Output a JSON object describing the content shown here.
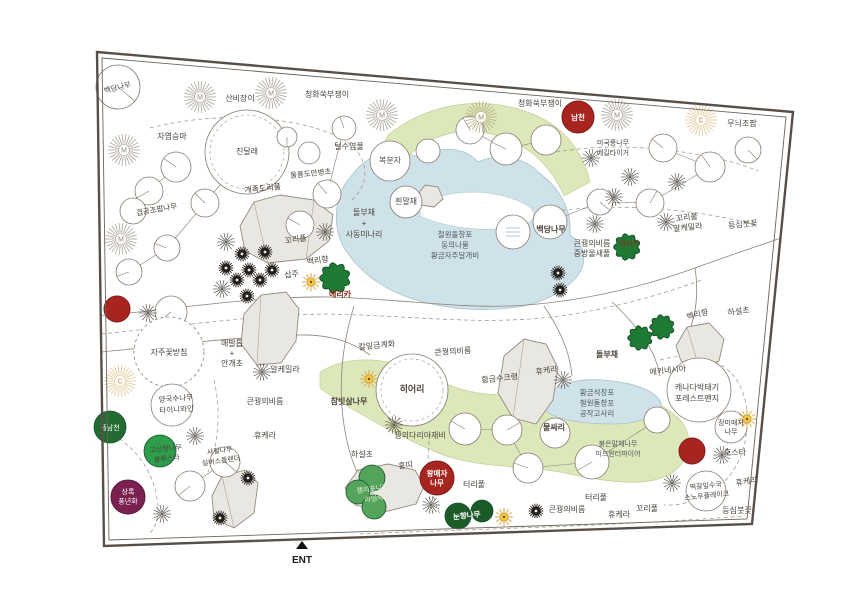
{
  "canvas": {
    "width": 850,
    "height": 600,
    "background": "#ffffff"
  },
  "palette": {
    "ink": "#4a443c",
    "pond_text": "#4e5a60",
    "accent_red_text": "#8b2b20",
    "white": "#ffffff",
    "line": "#8d8276",
    "dash": "#9b9186",
    "circle_edge": "#867b6e",
    "border": "#57504a",
    "border_inner": "#6d6459",
    "green_bed": "#dce7ba",
    "green_bed_edge": "#c3cf97",
    "pond": "#cfe2e9",
    "pond_edge": "#a9c2cb",
    "rock_fill": "#e9e7e2",
    "rock_edge": "#938b80",
    "rock_chord": "#aaa299",
    "red": "#a8241f",
    "red_edge": "#7e1b18",
    "maroon": "#7a2150",
    "maroon_edge": "#5c163b",
    "sun": "#f5c844",
    "sun_edge": "#cd9334",
    "sun_ray": "#dfa63c",
    "conifer": "#1f7a33",
    "conifer_edge": "#14532d",
    "pom": "#231e19",
    "star": "#3e3933",
    "burst_grey": "#b3aea6",
    "burst_olive": "#bcb488",
    "burst_tan": "#e6cda2",
    "burst_letter_grey": "#8d867c",
    "burst_letter_olive": "#8f8a5f",
    "burst_letter_tan": "#d08a33"
  },
  "border": {
    "outer": "97,52 793,112 752,524 104,546",
    "inner": "102,58 786,117 747,519 109,540"
  },
  "entrance": {
    "label": "ENT",
    "x": 302,
    "y": 563,
    "arrow": "296,549 308,549 302,541"
  },
  "beds": {
    "green": [
      "M388,135 C430,102 485,94 535,115 C565,128 583,152 590,182 L564,196 C552,168 532,148 504,138 C466,124 430,133 404,160 C398,167 394,176 392,186 L380,170 C380,156 383,145 388,135 Z",
      "M320,372 C352,352 395,358 438,380 C478,400 515,396 555,390 C600,383 648,392 676,416 C692,430 694,452 678,468 C658,488 616,484 570,474 C525,464 478,470 436,452 C396,435 344,406 320,388 Z"
    ],
    "ponds": [
      "M358,168 C375,150 400,148 420,158 C440,145 465,147 478,162 C500,152 525,158 538,172 C560,188 572,210 570,235 C585,245 588,262 578,275 C565,292 540,305 510,308 C475,312 440,308 410,298 C380,288 355,268 342,244 C332,222 336,195 348,180 Z",
      "M545,401 C550,386 575,378 602,380 C632,382 656,390 661,403 C663,415 640,424 612,424 C585,424 556,420 546,411 Z"
    ],
    "pond_islands": [
      "M420,206 C450,186 500,189 528,206 C538,213 536,222 518,226 C480,234 442,226 420,216 Z"
    ]
  },
  "rocks": [
    {
      "pts": "240,226 254,202 280,195 314,200 333,215 329,241 306,259 268,263 245,251",
      "chords": [
        "M254,202 L268,263",
        "M314,200 L306,259"
      ]
    },
    {
      "pts": "244,314 261,295 286,292 299,309 296,341 281,363 257,365 241,344",
      "chords": [
        "M261,295 L257,365"
      ]
    },
    {
      "pts": "504,356 524,339 546,344 558,368 553,400 536,424 513,418 498,393",
      "chords": [
        "M524,339 L513,418"
      ]
    },
    {
      "pts": "345,488 358,470 388,464 415,470 424,486 416,504 384,512 355,505",
      "chords": [
        "M358,470 L384,512"
      ]
    },
    {
      "pts": "212,496 222,476 246,470 258,483 254,513 234,528 214,519",
      "chords": [
        "M222,476 L234,528"
      ]
    },
    {
      "pts": "676,346 687,327 709,323 724,339 719,361 699,368 681,361",
      "chords": [
        "M687,327 L699,368"
      ]
    },
    {
      "pts": "416,197 425,185 438,187 443,199 434,207 420,205",
      "chords": []
    }
  ],
  "paths": {
    "solid": [
      "M101,316 C180,308 260,296 330,297 C400,299 455,308 510,306 C575,303 640,288 695,268 C725,257 755,247 781,238",
      "M102,352 C170,345 235,337 298,335 C330,334 352,342 370,355",
      "M354,306 C342,345 338,385 344,425 C348,455 360,485 378,508",
      "M612,302 C640,328 656,352 660,376",
      "M695,268 C700,300 694,330 678,352",
      "M544,306 C560,330 570,352 572,376"
    ],
    "dashed": [
      "M150,128 C220,110 300,116 345,140 C368,155 372,182 352,200",
      "M556,152 C610,143 665,147 715,158 C735,162 748,167 758,171",
      "M548,212 C605,204 660,207 710,215 C732,219 748,222 757,225",
      "M660,360 C695,350 725,360 738,382 C753,408 749,447 733,471 C716,496 688,506 664,505",
      "M360,534 C470,529 600,527 745,516",
      "M101,428 C133,443 152,468 157,498 C160,516 156,528 148,535",
      "M101,334 C180,326 255,315 325,314 C395,315 450,322 510,320 C580,318 645,300 702,280",
      "M214,380 C221,410 219,442 208,472",
      "M430,434 C426,460 428,488 440,514"
    ],
    "segments": [
      [
        176,
        167,
        149,
        191
      ],
      [
        149,
        191,
        133,
        211
      ],
      [
        205,
        203,
        167,
        248
      ],
      [
        167,
        248,
        129,
        272
      ],
      [
        247,
        152,
        205,
        203
      ],
      [
        344,
        128,
        327,
        194
      ],
      [
        327,
        194,
        300,
        225
      ],
      [
        663,
        148,
        710,
        167
      ],
      [
        710,
        167,
        650,
        203
      ],
      [
        650,
        203,
        600,
        202
      ],
      [
        600,
        202,
        550,
        222
      ],
      [
        546,
        140,
        506,
        149
      ],
      [
        506,
        149,
        470,
        130
      ],
      [
        465,
        429,
        507,
        430
      ],
      [
        507,
        430,
        528,
        468
      ],
      [
        528,
        468,
        592,
        462
      ],
      [
        592,
        462,
        657,
        420
      ],
      [
        190,
        486,
        225,
        462
      ]
    ]
  },
  "trees": [
    {
      "x": 118,
      "y": 87,
      "r": 22,
      "a": 40
    },
    {
      "x": 247,
      "y": 152,
      "r": 42,
      "inner": true
    },
    {
      "x": 176,
      "y": 167,
      "r": 15,
      "a": 215
    },
    {
      "x": 149,
      "y": 191,
      "r": 14,
      "a": 150
    },
    {
      "x": 133,
      "y": 211,
      "r": 13
    },
    {
      "x": 205,
      "y": 203,
      "r": 14,
      "a": 225
    },
    {
      "x": 167,
      "y": 248,
      "r": 13,
      "a": 200
    },
    {
      "x": 129,
      "y": 272,
      "r": 13,
      "a": 160
    },
    {
      "x": 287,
      "y": 137,
      "r": 10,
      "a": 90
    },
    {
      "x": 344,
      "y": 128,
      "r": 12,
      "a": 250
    },
    {
      "x": 309,
      "y": 153,
      "r": 11
    },
    {
      "x": 327,
      "y": 194,
      "r": 14,
      "a": 230
    },
    {
      "x": 390,
      "y": 161,
      "r": 20
    },
    {
      "x": 406,
      "y": 202,
      "r": 16
    },
    {
      "x": 470,
      "y": 130,
      "r": 14,
      "a": 240
    },
    {
      "x": 506,
      "y": 149,
      "r": 16,
      "a": 205
    },
    {
      "x": 546,
      "y": 140,
      "r": 15
    },
    {
      "x": 428,
      "y": 151,
      "r": 12
    },
    {
      "x": 663,
      "y": 148,
      "r": 14,
      "a": 220
    },
    {
      "x": 710,
      "y": 167,
      "r": 15,
      "a": 235
    },
    {
      "x": 600,
      "y": 202,
      "r": 13,
      "a": 40
    },
    {
      "x": 650,
      "y": 203,
      "r": 14,
      "a": 300
    },
    {
      "x": 748,
      "y": 150,
      "r": 13,
      "a": 45
    },
    {
      "x": 550,
      "y": 222,
      "r": 17
    },
    {
      "x": 513,
      "y": 232,
      "r": 17,
      "waves": true
    },
    {
      "x": 300,
      "y": 225,
      "r": 14,
      "a": 210
    },
    {
      "x": 171,
      "y": 312,
      "r": 16,
      "a": 140
    },
    {
      "x": 169,
      "y": 352,
      "r": 35,
      "dash": true
    },
    {
      "x": 172,
      "y": 405,
      "r": 21
    },
    {
      "x": 225,
      "y": 462,
      "r": 15,
      "a": 40
    },
    {
      "x": 190,
      "y": 486,
      "r": 15,
      "a": 140
    },
    {
      "x": 412,
      "y": 390,
      "r": 36,
      "inner": true
    },
    {
      "x": 465,
      "y": 429,
      "r": 16,
      "a": 210
    },
    {
      "x": 507,
      "y": 430,
      "r": 15,
      "a": 330
    },
    {
      "x": 528,
      "y": 468,
      "r": 15,
      "a": 200
    },
    {
      "x": 592,
      "y": 462,
      "r": 17,
      "a": 150
    },
    {
      "x": 657,
      "y": 420,
      "r": 13
    },
    {
      "x": 555,
      "y": 433,
      "r": 15
    },
    {
      "x": 699,
      "y": 390,
      "r": 32
    },
    {
      "x": 731,
      "y": 427,
      "r": 16
    },
    {
      "x": 706,
      "y": 491,
      "r": 20
    }
  ],
  "icons": {
    "sunbursts": [
      {
        "x": 124,
        "y": 150,
        "letter": "M",
        "variant": "grey"
      },
      {
        "x": 200,
        "y": 97,
        "letter": "M",
        "variant": "grey"
      },
      {
        "x": 271,
        "y": 93,
        "letter": "M",
        "variant": "grey"
      },
      {
        "x": 382,
        "y": 115,
        "letter": "M",
        "variant": "grey"
      },
      {
        "x": 617,
        "y": 115,
        "letter": "M",
        "variant": "grey"
      },
      {
        "x": 121,
        "y": 239,
        "letter": "M",
        "variant": "grey"
      },
      {
        "x": 481,
        "y": 117,
        "letter": "M",
        "variant": "olive"
      },
      {
        "x": 701,
        "y": 120,
        "letter": "C",
        "variant": "tan"
      },
      {
        "x": 120,
        "y": 381,
        "letter": "C",
        "variant": "tan"
      }
    ],
    "stars": [
      [
        226,
        242
      ],
      [
        325,
        232
      ],
      [
        222,
        289
      ],
      [
        148,
        313
      ],
      [
        262,
        372
      ],
      [
        195,
        436
      ],
      [
        162,
        514
      ],
      [
        431,
        505
      ],
      [
        563,
        380
      ],
      [
        672,
        483
      ],
      [
        722,
        455
      ],
      [
        591,
        158
      ],
      [
        630,
        177
      ],
      [
        677,
        182
      ],
      [
        614,
        197
      ],
      [
        595,
        224
      ],
      [
        666,
        222
      ],
      [
        394,
        425
      ]
    ],
    "poms": [
      [
        242,
        254
      ],
      [
        265,
        252
      ],
      [
        226,
        268
      ],
      [
        249,
        270
      ],
      [
        272,
        270
      ],
      [
        237,
        280
      ],
      [
        260,
        280
      ],
      [
        247,
        296
      ],
      [
        558,
        273
      ],
      [
        560,
        290
      ],
      [
        248,
        478
      ],
      [
        220,
        518
      ],
      [
        536,
        511
      ]
    ],
    "suns": [
      [
        311,
        282
      ],
      [
        369,
        379
      ],
      [
        504,
        517
      ],
      [
        747,
        419
      ]
    ],
    "conifers": [
      [
        335,
        278,
        15
      ],
      [
        627,
        247,
        13
      ],
      [
        640,
        338,
        12
      ],
      [
        662,
        327,
        12
      ]
    ]
  },
  "shrubs": {
    "red": [
      {
        "x": 578,
        "y": 117,
        "r": 16
      },
      {
        "x": 117,
        "y": 309,
        "r": 13
      },
      {
        "x": 692,
        "y": 451,
        "r": 13
      },
      {
        "x": 437,
        "y": 478,
        "r": 17
      }
    ],
    "green": [
      {
        "x": 110,
        "y": 427,
        "r": 16,
        "fill": "#236b32"
      },
      {
        "x": 160,
        "y": 451,
        "r": 16,
        "fill": "#2e9e4b"
      },
      {
        "x": 372,
        "y": 478,
        "r": 13,
        "fill": "#55a45b"
      },
      {
        "x": 358,
        "y": 492,
        "r": 12,
        "fill": "#55a45b"
      },
      {
        "x": 374,
        "y": 507,
        "r": 12,
        "fill": "#55a45b"
      },
      {
        "x": 458,
        "y": 516,
        "r": 13,
        "fill": "#1c5a2a"
      },
      {
        "x": 482,
        "y": 511,
        "r": 11,
        "fill": "#1c5a2a"
      }
    ],
    "maroon": [
      {
        "x": 128,
        "y": 497,
        "r": 17
      }
    ]
  },
  "labels": [
    {
      "t": [
        "백당나무"
      ],
      "x": 118,
      "y": 90,
      "rot": -14,
      "s": 7.5
    },
    {
      "t": [
        "산비장이"
      ],
      "x": 240,
      "y": 101
    },
    {
      "t": [
        "청화쑥부쟁이"
      ],
      "x": 327,
      "y": 97
    },
    {
      "t": [
        "청화쑥부쟁이"
      ],
      "x": 540,
      "y": 106
    },
    {
      "t": [
        "무늬조팝"
      ],
      "x": 742,
      "y": 126
    },
    {
      "t": [
        "자엽승마"
      ],
      "x": 172,
      "y": 139
    },
    {
      "t": [
        "진달래"
      ],
      "x": 247,
      "y": 154
    },
    {
      "t": [
        "털수염풀"
      ],
      "x": 349,
      "y": 149
    },
    {
      "t": [
        "울릉도만병초"
      ],
      "x": 311,
      "y": 176,
      "rot": -6,
      "s": 7.5
    },
    {
      "t": [
        "복분자"
      ],
      "x": 390,
      "y": 163
    },
    {
      "t": [
        "미국풍나무",
        "베길타이거"
      ],
      "x": 613,
      "y": 145,
      "s": 7,
      "lh": 10
    },
    {
      "t": [
        "개족도리풀"
      ],
      "x": 263,
      "y": 191,
      "rot": -6
    },
    {
      "t": [
        "겹공조팝나무"
      ],
      "x": 157,
      "y": 212,
      "rot": -10,
      "s": 7.5
    },
    {
      "t": [
        "돌부채",
        "+",
        "사동미나리"
      ],
      "x": 364,
      "y": 215,
      "lh": 11
    },
    {
      "t": [
        "흰말채"
      ],
      "x": 406,
      "y": 204
    },
    {
      "t": [
        "꼬리풀"
      ],
      "x": 296,
      "y": 242,
      "rot": -8
    },
    {
      "t": [
        "백리향"
      ],
      "x": 318,
      "y": 263,
      "rot": -8
    },
    {
      "t": [
        "삽주"
      ],
      "x": 292,
      "y": 277,
      "rot": -8
    },
    {
      "t": [
        "에리카"
      ],
      "x": 340,
      "y": 297,
      "c": "accent_red_text",
      "b": 1
    },
    {
      "t": [
        "철원돌창포",
        "동의나물",
        "황금자주달개비"
      ],
      "x": 455,
      "y": 237,
      "c": "pond_text",
      "s": 7.5,
      "lh": 10.5
    },
    {
      "t": [
        "백당나무"
      ],
      "x": 551,
      "y": 232,
      "b": 1
    },
    {
      "t": [
        "큰꿩의비름",
        "중방울새풀"
      ],
      "x": 592,
      "y": 246,
      "lh": 10
    },
    {
      "t": [
        "에리카"
      ],
      "x": 629,
      "y": 246,
      "c": "accent_red_text",
      "s": 7.5
    },
    {
      "t": [
        "꼬리풀",
        "알케밀라"
      ],
      "x": 687,
      "y": 220,
      "lh": 10,
      "rot": -6
    },
    {
      "t": [
        "등심붓꽃"
      ],
      "x": 743,
      "y": 227,
      "rot": -5
    },
    {
      "t": [
        "백리향"
      ],
      "x": 698,
      "y": 317,
      "rot": -14
    },
    {
      "t": [
        "하설초"
      ],
      "x": 739,
      "y": 314,
      "rot": -8
    },
    {
      "t": [
        "돌부채"
      ],
      "x": 607,
      "y": 357,
      "b": 1
    },
    {
      "t": [
        "에키네시아"
      ],
      "x": 668,
      "y": 373,
      "rot": -6
    },
    {
      "t": [
        "캐나다박태기",
        "포레스트팬지"
      ],
      "x": 697,
      "y": 390,
      "lh": 11
    },
    {
      "t": [
        "장미매자",
        "나무"
      ],
      "x": 731,
      "y": 425,
      "s": 7,
      "lh": 9
    },
    {
      "t": [
        "호스타"
      ],
      "x": 735,
      "y": 455
    },
    {
      "t": [
        "휴케라"
      ],
      "x": 747,
      "y": 484,
      "rot": -8
    },
    {
      "t": [
        "떡갈잎수국",
        "스노우플레이크"
      ],
      "x": 706,
      "y": 488,
      "s": 7,
      "lh": 10,
      "rot": -6
    },
    {
      "t": [
        "등심붓꽃"
      ],
      "x": 737,
      "y": 513
    },
    {
      "t": [
        "꼬리풀"
      ],
      "x": 647,
      "y": 511
    },
    {
      "t": [
        "휴케라"
      ],
      "x": 619,
      "y": 517
    },
    {
      "t": [
        "큰꿩의비름"
      ],
      "x": 567,
      "y": 512
    },
    {
      "t": [
        "터리풀"
      ],
      "x": 596,
      "y": 500
    },
    {
      "t": [
        "터리풀"
      ],
      "x": 474,
      "y": 487
    },
    {
      "t": [
        "붉은말채나무",
        "미드윈터파이어"
      ],
      "x": 618,
      "y": 446,
      "s": 7,
      "lh": 10,
      "c": "pond_text"
    },
    {
      "t": [
        "황금석창포",
        "철원돌창포",
        "공작고사리"
      ],
      "x": 597,
      "y": 395,
      "c": "pond_text",
      "s": 7.5,
      "lh": 10.5
    },
    {
      "t": [
        "물싸리"
      ],
      "x": 554,
      "y": 430,
      "b": 1
    },
    {
      "t": [
        "휴케라"
      ],
      "x": 547,
      "y": 373,
      "rot": -8
    },
    {
      "t": [
        "황금수크령"
      ],
      "x": 500,
      "y": 381,
      "rot": -6
    },
    {
      "t": [
        "큰꿩의비름"
      ],
      "x": 453,
      "y": 354,
      "rot": -4
    },
    {
      "t": [
        "칼잎금계화"
      ],
      "x": 377,
      "y": 348,
      "rot": -6
    },
    {
      "t": [
        "히어리"
      ],
      "x": 412,
      "y": 392,
      "s": 9,
      "b": 1
    },
    {
      "t": [
        "참빗살나무"
      ],
      "x": 349,
      "y": 404,
      "b": 1
    },
    {
      "t": [
        "꿩의다리아재비"
      ],
      "x": 420,
      "y": 438
    },
    {
      "t": [
        "하설초"
      ],
      "x": 362,
      "y": 457
    },
    {
      "t": [
        "홍띠"
      ],
      "x": 406,
      "y": 468,
      "rot": -8
    },
    {
      "t": [
        "왕매자",
        "나무"
      ],
      "x": 437,
      "y": 476,
      "c": "white",
      "s": 7.5,
      "lh": 9.5,
      "b": 1
    },
    {
      "t": [
        "캘리포니아",
        "라일락"
      ],
      "x": 373,
      "y": 491,
      "c": "#e3f0cf",
      "s": 7,
      "lh": 10,
      "rot": -8
    },
    {
      "t": [
        "눈향나무"
      ],
      "x": 467,
      "y": 518,
      "c": "white",
      "s": 7.5,
      "rot": -6,
      "b": 1
    },
    {
      "t": [
        "큰꿩의비름"
      ],
      "x": 265,
      "y": 404
    },
    {
      "t": [
        "매발톱",
        "+",
        "안개초"
      ],
      "x": 232,
      "y": 346,
      "lh": 10
    },
    {
      "t": [
        "자주꽃받침"
      ],
      "x": 169,
      "y": 355
    },
    {
      "t": [
        "알케밀라"
      ],
      "x": 285,
      "y": 372
    },
    {
      "t": [
        "양국수나무",
        "타이니와인"
      ],
      "x": 176,
      "y": 401,
      "s": 7.5,
      "lh": 11,
      "rot": -4
    },
    {
      "t": [
        "휴케라"
      ],
      "x": 265,
      "y": 438
    },
    {
      "t": [
        "고산향나무",
        "블루스타"
      ],
      "x": 166,
      "y": 451,
      "s": 7,
      "lh": 10,
      "rot": -6
    },
    {
      "t": [
        "사철나무",
        "실버스플렌더"
      ],
      "x": 220,
      "y": 453,
      "s": 7,
      "lh": 10,
      "rot": -8
    },
    {
      "t": [
        "풀남천"
      ],
      "x": 110,
      "y": 430,
      "c": "white",
      "s": 7
    },
    {
      "t": [
        "상록",
        "풍년화"
      ],
      "x": 128,
      "y": 494,
      "c": "white",
      "s": 7,
      "lh": 9.5
    },
    {
      "t": [
        "남천"
      ],
      "x": 578,
      "y": 120,
      "c": "white",
      "s": 7.5,
      "b": 1
    }
  ]
}
